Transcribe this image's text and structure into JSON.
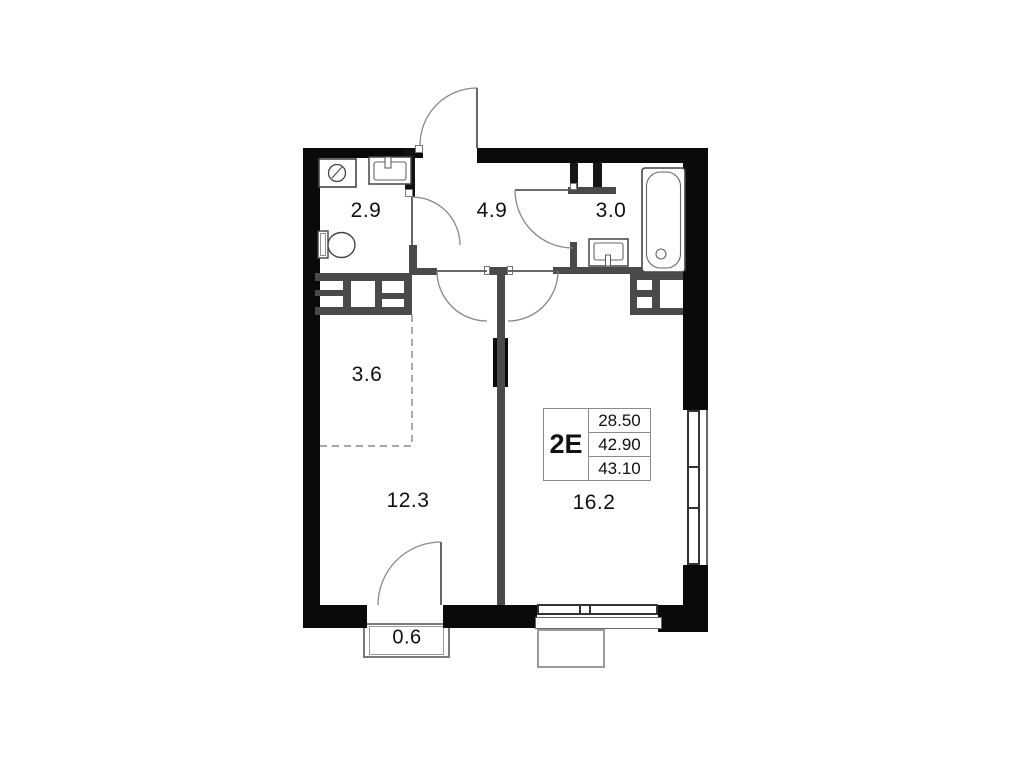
{
  "plan": {
    "title": "apartment floor plan",
    "info_box": {
      "unit_label": "2E",
      "values": [
        "28.50",
        "42.90",
        "43.10"
      ]
    },
    "rooms": [
      {
        "name": "bathroom-small",
        "area": "2.9"
      },
      {
        "name": "hallway",
        "area": "4.9"
      },
      {
        "name": "bathroom",
        "area": "3.0"
      },
      {
        "name": "wardrobe-zone",
        "area": "3.6"
      },
      {
        "name": "bedroom",
        "area": "12.3"
      },
      {
        "name": "living-room",
        "area": "16.2"
      },
      {
        "name": "balcony",
        "area": "0.6"
      }
    ],
    "fixtures": [
      "washing-machine",
      "sink",
      "toilet",
      "bathtub",
      "sink"
    ],
    "colors": {
      "exterior_wall": "#0a0a0a",
      "interior_wall": "#4a4a4a",
      "line": "#888888",
      "background": "#ffffff"
    }
  }
}
